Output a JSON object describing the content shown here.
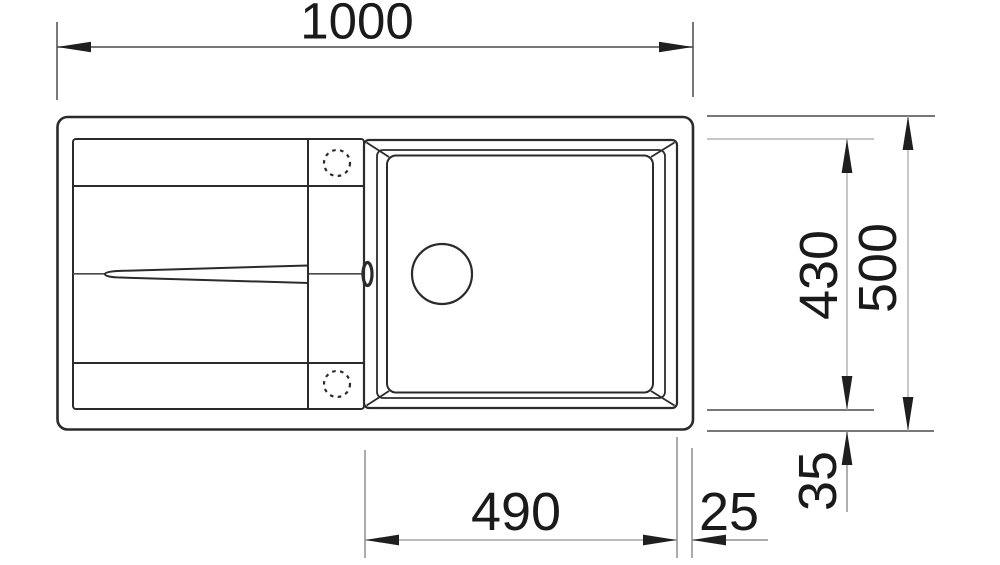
{
  "diagram": {
    "type": "technical dimension drawing (top view)",
    "subject": "inset kitchen sink with drainboard, single bowl",
    "units": "mm",
    "colors": {
      "object_line": "#2b2b2b",
      "dimension_line": "#aaaaaa",
      "extension_line": "#4a4a4a",
      "arrow": "#1f1f1f",
      "text": "#1a1a1a",
      "background": "#ffffff"
    },
    "dimensions": {
      "overall_width": "1000",
      "overall_depth": "500",
      "bowl_depth": "430",
      "bowl_width": "490",
      "bowl_offset_right": "25",
      "bowl_offset_bottom": "35"
    }
  }
}
